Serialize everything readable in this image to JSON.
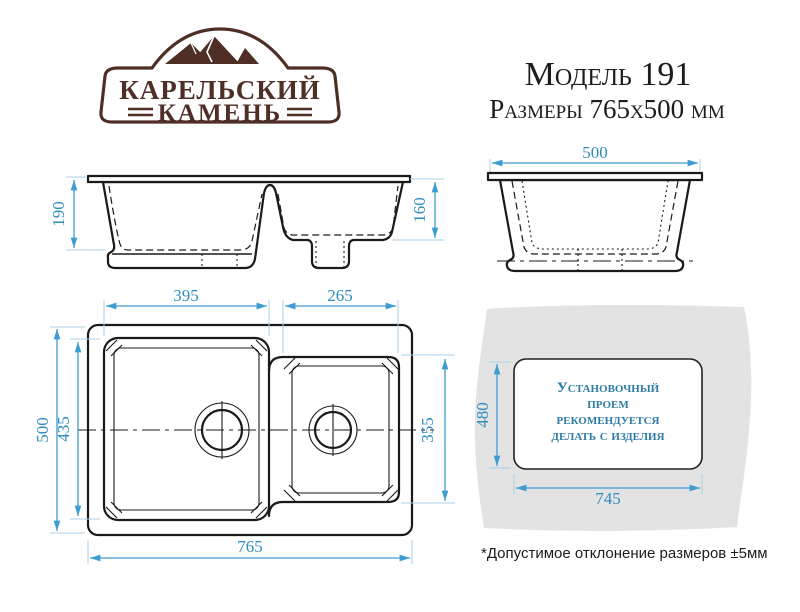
{
  "logo": {
    "brand_top": "КАРЕЛЬСКИЙ",
    "brand_bottom": "КАМЕНЬ"
  },
  "header": {
    "model": "Модель 191",
    "dimensions": "Размеры 765x500 мм"
  },
  "front_view": {
    "depth_main_bowl": "190",
    "depth_second_bowl": "160"
  },
  "side_view": {
    "overall_width": "500"
  },
  "top_view": {
    "main_bowl_width": "395",
    "second_bowl_width": "265",
    "overall_length": "765",
    "overall_width": "500",
    "main_bowl_length": "435",
    "second_bowl_length": "355"
  },
  "cutout": {
    "height": "480",
    "width": "745",
    "note_lines": [
      "Установочный",
      "проем",
      "рекомендуется",
      "делать с изделия"
    ]
  },
  "footnote": "*Допустимое отклонение размеров ±5мм",
  "colors": {
    "dimension_blue": "#3d9cd2",
    "dimension_text": "#2e8cc0",
    "brand_brown": "#4f2f25",
    "note_teal": "#2e7ca6",
    "countertop_gray": "#e3e3e3",
    "line_black": "#1a1a1a"
  }
}
